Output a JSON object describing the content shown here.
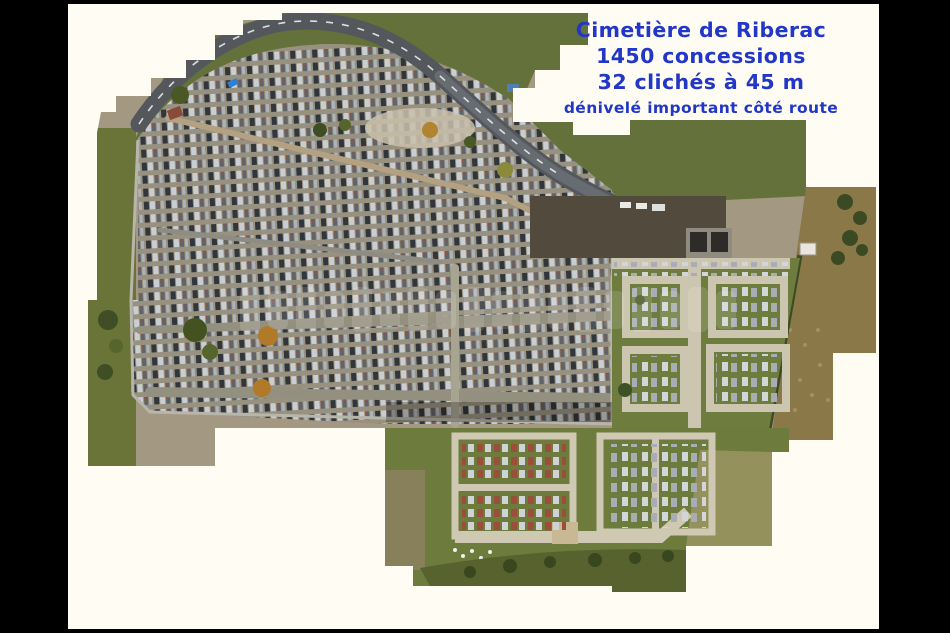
{
  "annotation": {
    "line1": "Cimetière de Riberac",
    "line2": "1450 concessions",
    "line3": "32 clichés à 45 m",
    "line4": "dénivelé important côté route",
    "text_color": "#2236c7"
  },
  "watermark": {
    "legible": false,
    "style": "translucent white block letters across the centre of the photo"
  },
  "scene": {
    "description": "drone orthophoto mosaic of a cemetery with stair-stepped tile edges on an off-white page, black letterbox borders",
    "palette": {
      "letterbox": "#000000",
      "page": "#fffdf3",
      "asphalt_road": "#54585d",
      "road_marking": "#eceff0",
      "ground": "#a39882",
      "grass_verge": "#64713a",
      "lawn": "#6d7b3d",
      "scrub_hedge": "#4c5829",
      "farmland": "#8a7848",
      "light_paths": "#ccc5af",
      "tomb_dark": "#31363d",
      "tomb_light": "#c9ced2",
      "wall": "#b8b5aa",
      "maintenance_yard": "#534a3e",
      "car_blue": "#2f7fd6"
    }
  }
}
